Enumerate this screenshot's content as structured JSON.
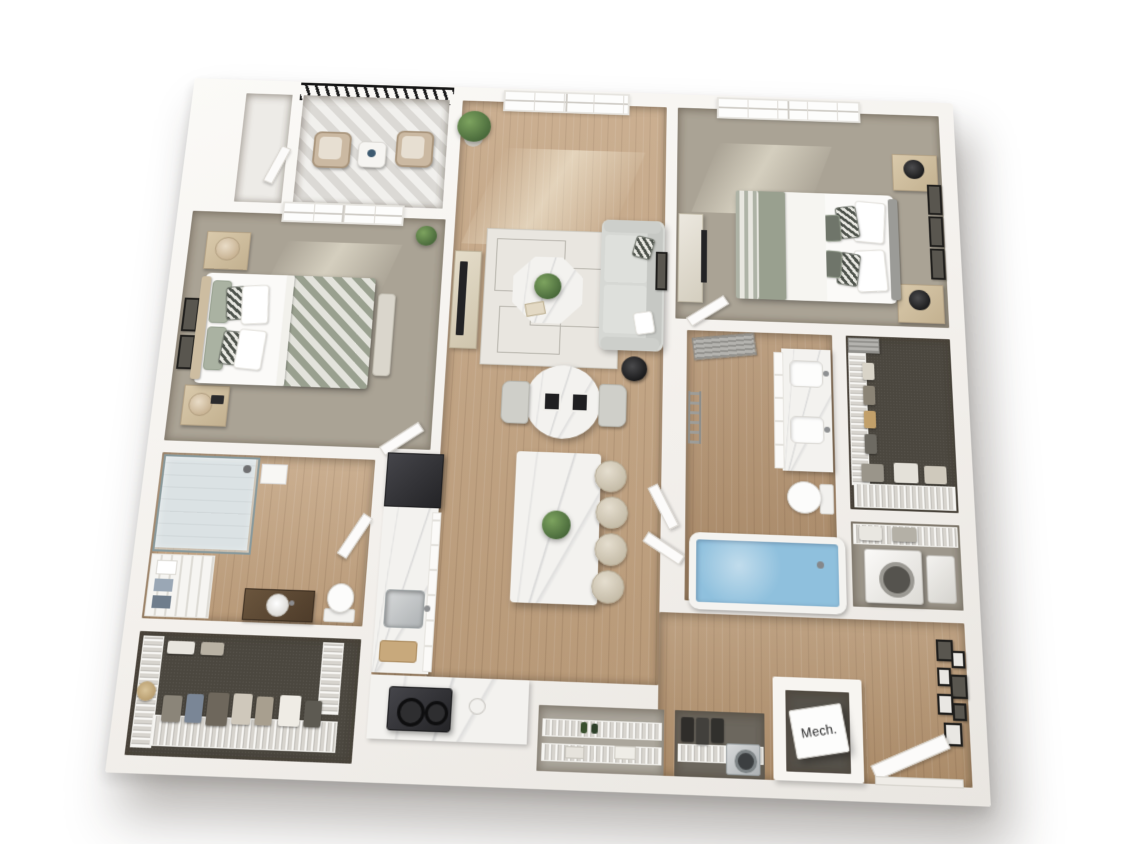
{
  "meta": {
    "type": "3d-floor-plan-render",
    "description": "Top-down 3D rendering of a two-bedroom, two-bathroom apartment floor plan with balcony, open kitchen-living area, walk-in closets, laundry and mechanical room"
  },
  "labels": {
    "mechanical_room": "Mech."
  },
  "rooms": [
    {
      "id": "balcony",
      "name": "Balcony",
      "features": [
        "metal-railing",
        "wicker-chair",
        "wicker-chair",
        "side-table"
      ]
    },
    {
      "id": "entry-closet",
      "name": "Entry Closet",
      "features": [
        "door"
      ]
    },
    {
      "id": "bedroom-1",
      "name": "Bedroom 1",
      "features": [
        "queen-bed",
        "chevron-blanket",
        "nightstand",
        "nightstand",
        "table-lamp",
        "table-lamp",
        "bench",
        "wall-art",
        "window",
        "plant",
        "door"
      ]
    },
    {
      "id": "bathroom-1",
      "name": "Bathroom 1",
      "features": [
        "glass-shower",
        "linen-shelves",
        "wood-vanity",
        "vessel-sink",
        "toilet",
        "door"
      ]
    },
    {
      "id": "walk-in-closet-1",
      "name": "Walk-in Closet 1",
      "features": [
        "wire-shelving",
        "hanging-clothes",
        "hat"
      ]
    },
    {
      "id": "living-room",
      "name": "Living Room",
      "features": [
        "sofa",
        "area-rug",
        "octagon-coffee-table",
        "plant",
        "tv-console",
        "side-table",
        "window",
        "wall-art",
        "potted-plant"
      ]
    },
    {
      "id": "dining-area",
      "name": "Dining Area",
      "features": [
        "round-marble-table",
        "dining-chair",
        "dining-chair",
        "place-settings"
      ]
    },
    {
      "id": "kitchen",
      "name": "Kitchen",
      "features": [
        "refrigerator",
        "marble-counter",
        "sink",
        "cutting-board",
        "cooktop",
        "island",
        "bar-stool",
        "bar-stool",
        "bar-stool",
        "bar-stool",
        "island-plant"
      ]
    },
    {
      "id": "pantry-closet",
      "name": "Pantry Closet",
      "features": [
        "wire-shelving",
        "bottles"
      ]
    },
    {
      "id": "coat-closet",
      "name": "Coat Closet",
      "features": [
        "wire-shelving",
        "hanging-coats",
        "appliance"
      ]
    },
    {
      "id": "bedroom-2",
      "name": "Bedroom 2",
      "features": [
        "queen-bed",
        "striped-blanket",
        "nightstand",
        "nightstand",
        "table-lamp",
        "table-lamp",
        "dresser",
        "tv",
        "wall-art",
        "window",
        "door"
      ]
    },
    {
      "id": "bathroom-2",
      "name": "Bathroom 2",
      "features": [
        "double-vanity",
        "sink",
        "sink",
        "toilet",
        "bathtub",
        "louvered-barn-door",
        "towel-ladder"
      ]
    },
    {
      "id": "walk-in-closet-2",
      "name": "Walk-in Closet 2",
      "features": [
        "wire-shelving",
        "hanging-clothes",
        "baskets",
        "louvered-door"
      ]
    },
    {
      "id": "laundry-closet",
      "name": "Laundry Closet",
      "features": [
        "wire-shelf",
        "bins",
        "washer"
      ]
    },
    {
      "id": "entry-hall",
      "name": "Entry Hall",
      "features": [
        "gallery-wall",
        "front-door"
      ]
    },
    {
      "id": "mechanical-room",
      "name": "Mechanical Room",
      "features": [
        "mech-unit-cube"
      ]
    }
  ],
  "colors": {
    "wall": "#f7f5f1",
    "wood_floor": "#c2a27f",
    "bedroom_carpet": "#aaa395",
    "closet_carpet": "#4b473f",
    "balcony_tile": "#e8e6e2",
    "marble": "#f3f2ef",
    "sofa": "#d6d8d4",
    "blanket_sage": "#99a08f",
    "refrigerator": "#36363a",
    "bathtub_water": "#8fc0dd",
    "plant_green": "#5d7f49",
    "railing": "#1d1d1d",
    "accent_wood": "#cdbda1"
  }
}
